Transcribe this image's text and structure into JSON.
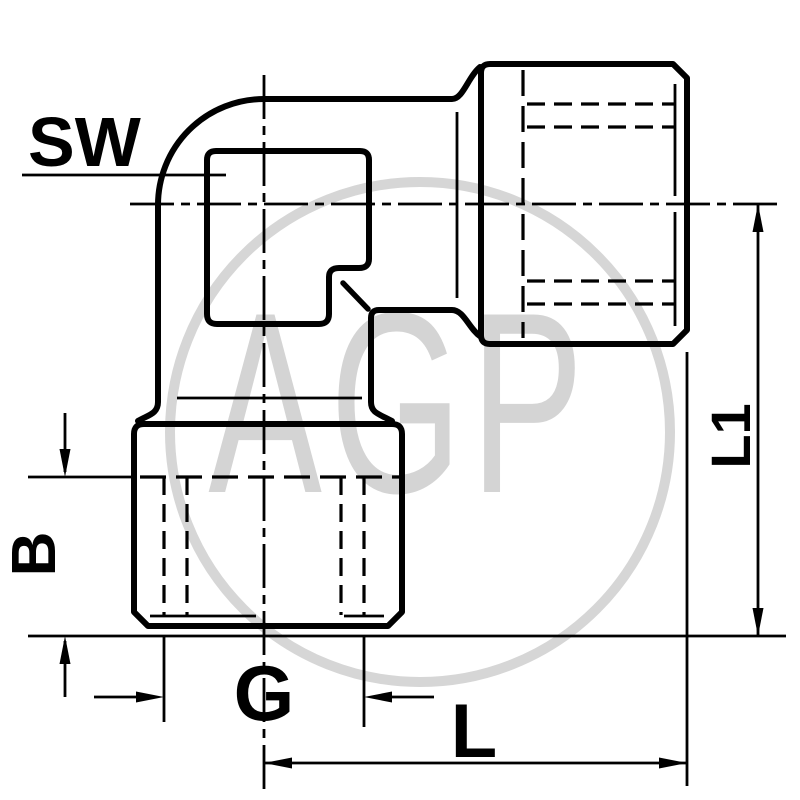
{
  "page": {
    "background_color": "#ffffff",
    "line_color": "#000000",
    "watermark_color": "#d4d4d4"
  },
  "drawing": {
    "description_labels": {
      "sw": "SW",
      "b": "B",
      "g": "G",
      "l": "L",
      "l1": "L1"
    }
  },
  "watermark": {
    "text": "AGP"
  }
}
